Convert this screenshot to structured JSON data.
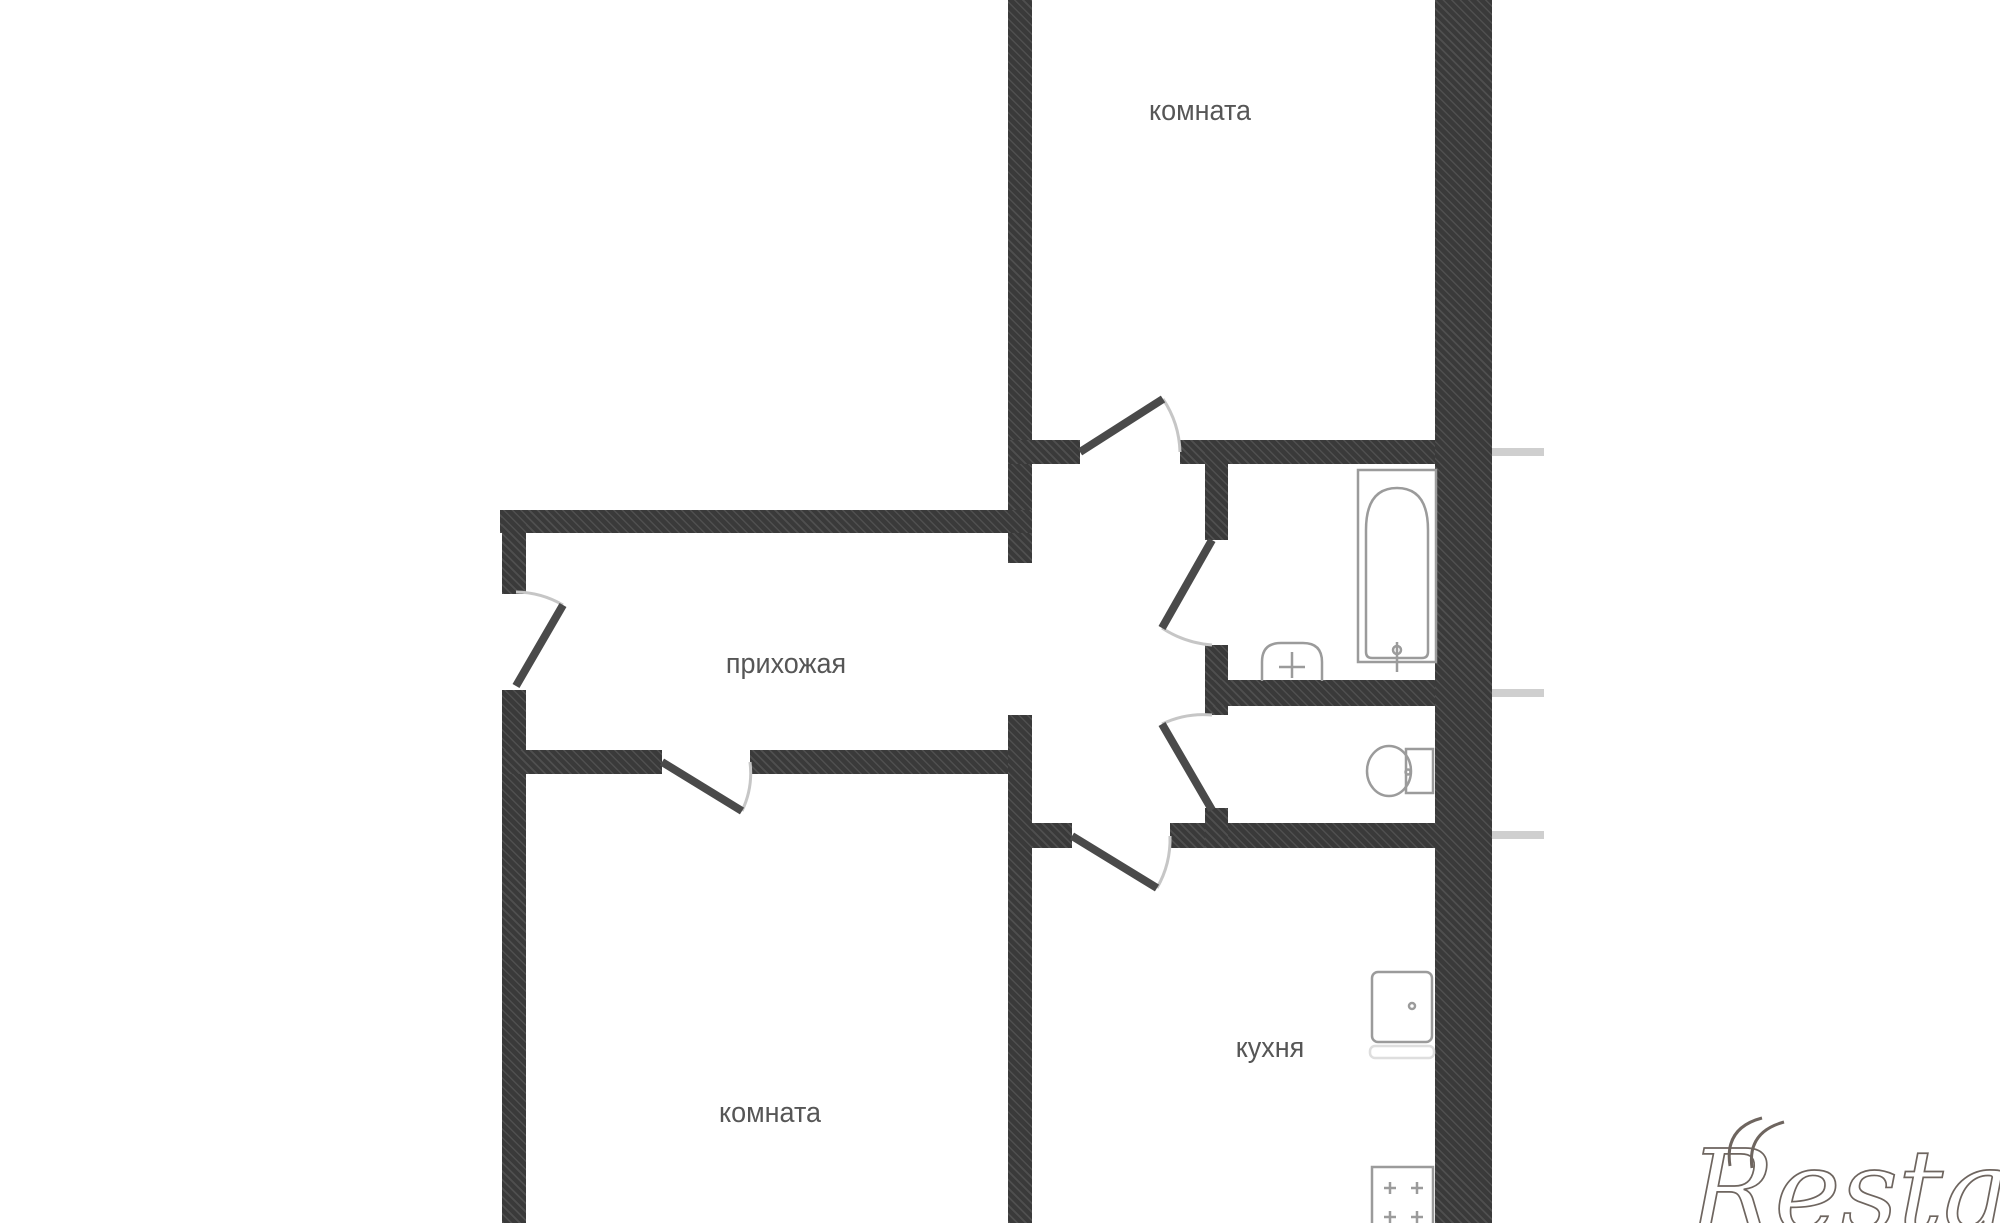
{
  "title": "apartment-floor-plan",
  "rooms": [
    {
      "id": "room-top",
      "label": "комната"
    },
    {
      "id": "hallway",
      "label": "прихожая"
    },
    {
      "id": "room-bottom",
      "label": "комната"
    },
    {
      "id": "kitchen",
      "label": "кухня"
    }
  ],
  "fixtures": [
    {
      "id": "bathtub"
    },
    {
      "id": "bathroom-sink"
    },
    {
      "id": "toilet"
    },
    {
      "id": "kitchen-sink"
    },
    {
      "id": "stove"
    }
  ],
  "watermark": {
    "text": "Restate"
  },
  "colors": {
    "background": "#ffffff",
    "wall": "#3a3a3a",
    "wall_hatch_light": "#4f4f4f",
    "door_leaf": "#4a4a4a",
    "door_arc": "#c6c6c6",
    "fixture_line": "#9b9b9b",
    "label_text": "#565656",
    "watermark": "#6e655f",
    "stub": "#cfcfcf"
  }
}
